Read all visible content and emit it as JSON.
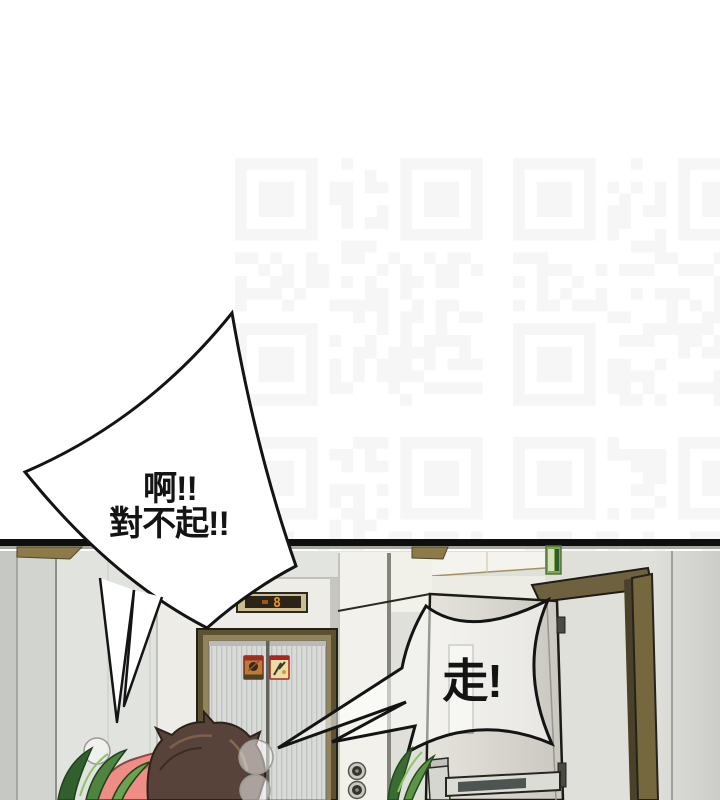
{
  "page_title": "comic-panel-hallway-elevator",
  "speech": {
    "apology_line1": "啊!!",
    "apology_line2": "對不起!!",
    "command": "走!"
  },
  "elevator": {
    "floor_display": "8"
  },
  "colors": {
    "indicator_digit": "#ed9423",
    "indicator_display_bg": "#2c2517",
    "elevator_frame_bronze": "#93835a",
    "exit_sign_green": "#7fa557",
    "hair_brown": "#57433a",
    "shirt_pink": "#ed8d85",
    "leaf_green": "#4e8340",
    "wall_gray": "#e2e4df",
    "outline_black": "#141414"
  },
  "icons": {
    "floor_indicator": "seven-segment-digit",
    "warning_sign_left": "no-touch-pictogram",
    "warning_sign_right": "shock-warning-pictogram",
    "exit_sign": "green-exit-plate",
    "door_locks": "double-deadbolt-circles",
    "watermark": "faint-qr-pattern"
  }
}
